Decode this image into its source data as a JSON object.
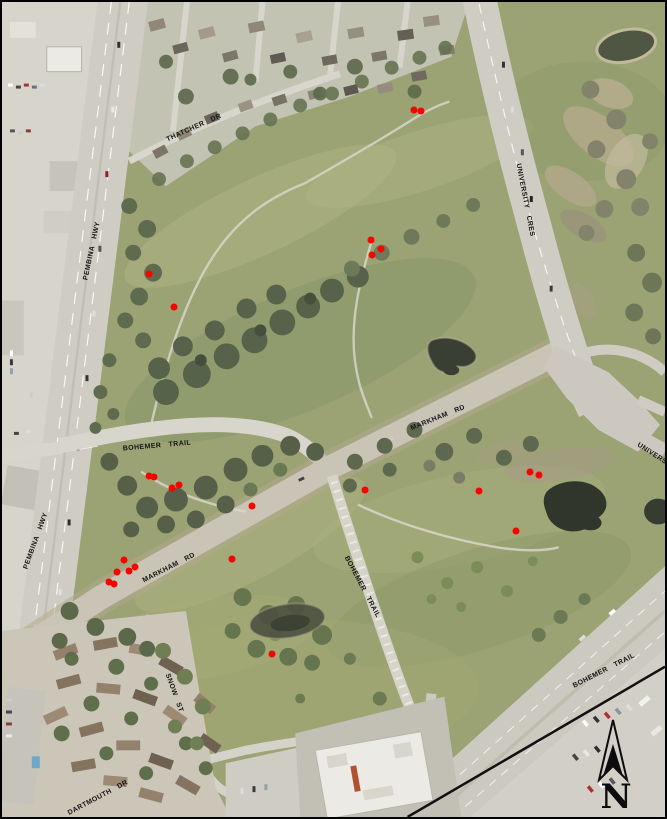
{
  "map": {
    "description": "aerial orthophoto of golf course and park lands with red survey point markers",
    "border_color": "#000000"
  },
  "colors": {
    "marker_red": "#f50400",
    "label_text": "#141414",
    "grass": "#9ba273",
    "trees": "#57624a",
    "road": "#d3d0c6",
    "water": "#343a2e",
    "urban": "#d6d3cb",
    "boundary_line": "#111111"
  },
  "road_labels": [
    {
      "id": "thatcher-dr",
      "text": "THATCHER DR",
      "x": 192,
      "y": 126,
      "rot": -24
    },
    {
      "id": "pembina-hwy-n",
      "text": "PEMBINA HWY",
      "x": 90,
      "y": 249,
      "rot": -78
    },
    {
      "id": "university-cres",
      "text": "UNIVERSITY CRES",
      "x": 523,
      "y": 198,
      "rot": 79
    },
    {
      "id": "bohemer-trail-w",
      "text": "BOHEMER TRAIL",
      "x": 155,
      "y": 444,
      "rot": -5
    },
    {
      "id": "markham-rd-e",
      "text": "MARKHAM RD",
      "x": 436,
      "y": 416,
      "rot": -22
    },
    {
      "id": "university-e",
      "text": "UNIVERSITY",
      "x": 655,
      "y": 455,
      "rot": 33
    },
    {
      "id": "pembina-hwy-s",
      "text": "PEMBINA HWY",
      "x": 34,
      "y": 539,
      "rot": -70
    },
    {
      "id": "markham-rd-w",
      "text": "MARKHAM RD",
      "x": 167,
      "y": 566,
      "rot": -27
    },
    {
      "id": "bohemer-trail-s",
      "text": "BOHEMER TRAIL",
      "x": 360,
      "y": 585,
      "rot": 62
    },
    {
      "id": "bohemer-trail-se",
      "text": "BOHEMER TRAIL",
      "x": 602,
      "y": 669,
      "rot": -27
    },
    {
      "id": "snow-st",
      "text": "SNOW ST",
      "x": 172,
      "y": 691,
      "rot": 70
    },
    {
      "id": "dartmouth-dr",
      "text": "DARTMOUTH DR",
      "x": 96,
      "y": 796,
      "rot": -28
    }
  ],
  "markers": [
    {
      "x": 412,
      "y": 108
    },
    {
      "x": 419,
      "y": 109
    },
    {
      "x": 147,
      "y": 272
    },
    {
      "x": 172,
      "y": 305
    },
    {
      "x": 369,
      "y": 238
    },
    {
      "x": 379,
      "y": 247
    },
    {
      "x": 370,
      "y": 253
    },
    {
      "x": 147,
      "y": 474
    },
    {
      "x": 152,
      "y": 475
    },
    {
      "x": 170,
      "y": 486
    },
    {
      "x": 177,
      "y": 483
    },
    {
      "x": 250,
      "y": 504
    },
    {
      "x": 363,
      "y": 488
    },
    {
      "x": 528,
      "y": 470
    },
    {
      "x": 537,
      "y": 473
    },
    {
      "x": 477,
      "y": 489
    },
    {
      "x": 514,
      "y": 529
    },
    {
      "x": 230,
      "y": 557
    },
    {
      "x": 122,
      "y": 558
    },
    {
      "x": 133,
      "y": 565
    },
    {
      "x": 127,
      "y": 569
    },
    {
      "x": 115,
      "y": 570
    },
    {
      "x": 107,
      "y": 580
    },
    {
      "x": 112,
      "y": 582
    },
    {
      "x": 270,
      "y": 652
    }
  ],
  "north_arrow": {
    "label": "N"
  },
  "boundary_line": {
    "x1": 667,
    "y1": 668,
    "x2": 408,
    "y2": 819
  }
}
